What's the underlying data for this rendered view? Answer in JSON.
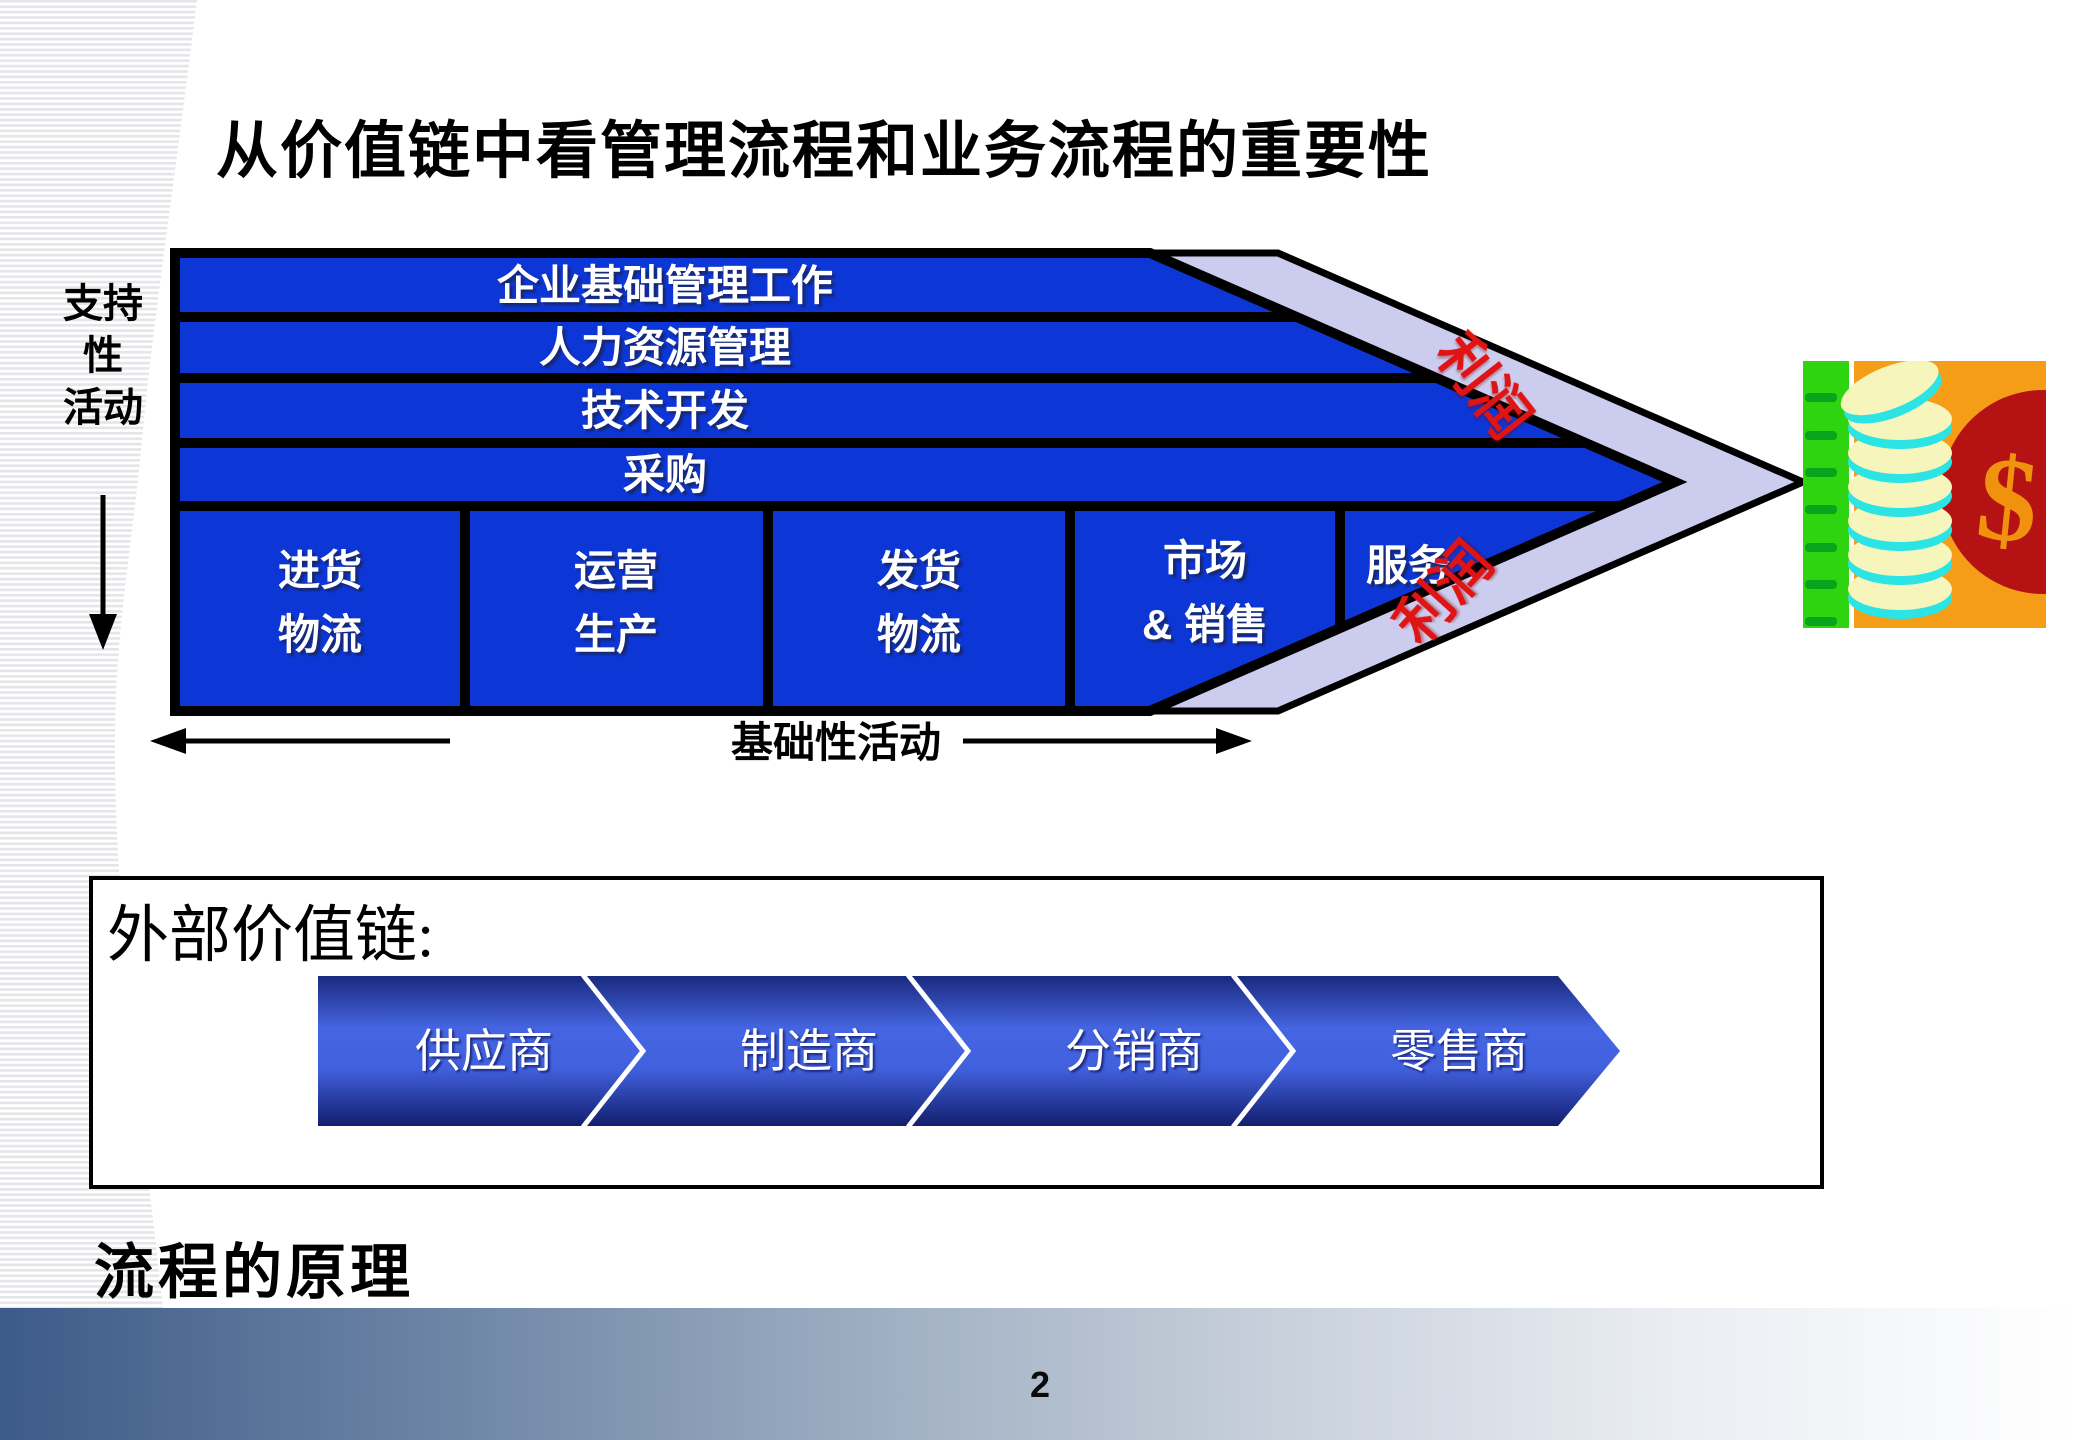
{
  "slide": {
    "title": "从价值链中看管理流程和业务流程的重要性",
    "footer_heading": "流程的原理",
    "page_number": "2"
  },
  "value_chain": {
    "support_axis": {
      "lines": [
        "支持",
        "性",
        "活动"
      ]
    },
    "support_activities": [
      "企业基础管理工作",
      "人力资源管理",
      "技术开发",
      "采购"
    ],
    "primary_activities": [
      {
        "lines": [
          "进货",
          "物流"
        ]
      },
      {
        "lines": [
          "运营",
          "生产"
        ]
      },
      {
        "lines": [
          "发货",
          "物流"
        ]
      },
      {
        "lines": [
          "市场",
          "& 销售"
        ]
      },
      {
        "lines": [
          "服务"
        ]
      }
    ],
    "profit_labels": [
      "利润",
      "利润"
    ],
    "primary_axis_label": "基础性活动"
  },
  "external_chain": {
    "heading": "外部价值链:",
    "stages": [
      "供应商",
      "制造商",
      "分销商",
      "零售商"
    ]
  },
  "money_graphic": {
    "dollar_sign": "$"
  },
  "colors": {
    "chain_blue": "#0d36d6",
    "profit_band_lavender": "#cccdee",
    "profit_red": "#e01414",
    "stage_gradient_mid": "#4565e2",
    "stage_gradient_dark": "#19297e",
    "footer_bar_left": "#3d5b88",
    "money_bag_red": "#b51313",
    "money_orange": "#f59d16",
    "ledger_green": "#2fd410",
    "coin_cyan": "#2de4e4",
    "coin_face": "#f6f6bc"
  }
}
